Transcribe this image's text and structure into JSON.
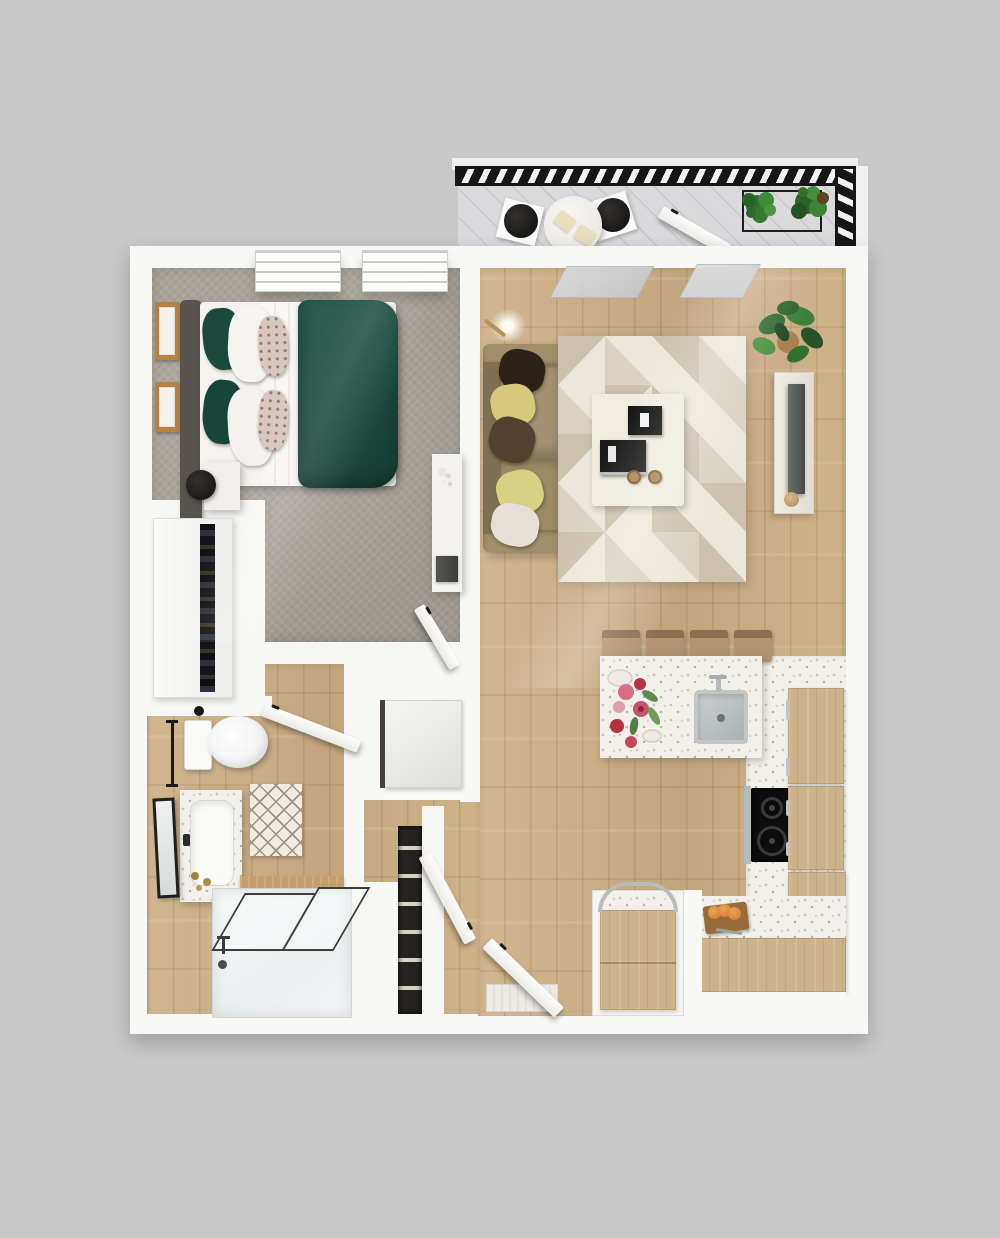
{
  "meta": {
    "scene": "3D rendered top-down floor plan of a one-bedroom apartment with balcony",
    "visible_text": "none",
    "background_color": "#c8c8c8"
  },
  "palette": {
    "background": "#c8c8c8",
    "walls": "#f7f7f4",
    "wood_floor": "#c9ad85",
    "carpet_gray": "#a8a29a",
    "duvet_green": "#1d4a3f",
    "sofa_olive": "#96865f",
    "cabinet_wood": "#cdb38c",
    "terrazzo_counter": "#f2f0ea",
    "railing_black": "#161616",
    "plant_green": "#3a7d36",
    "stainless_steel": "#b7bab9",
    "cooktop_black": "#0d0d0d",
    "accent_brass": "#a6813e"
  },
  "rooms": {
    "balcony": {
      "label": "Balcony",
      "items": [
        "black hatched safety railing",
        "diagonal plank deck",
        "round bistro table with two place settings",
        "two black bistro chairs",
        "planter stand with two green plants",
        "open balcony door"
      ]
    },
    "bedroom": {
      "label": "Bedroom",
      "items": [
        "queen bed with dark green duvet and white sheets",
        "gray upholstered headboard",
        "green, white and floral throw pillows",
        "tan blanket runner",
        "nightstand with black alarm clock",
        "two wood-framed artworks",
        "two windows",
        "white desk with laptop and flowers",
        "gray carpet",
        "open bedroom door"
      ]
    },
    "closet": {
      "label": "Closet",
      "items": [
        "white wardrobe with hanging clothes gap"
      ]
    },
    "bathroom": {
      "label": "Bathroom",
      "items": [
        "toilet",
        "vanity with inset sink and brass fixtures",
        "black-framed leaning mirror",
        "diamond lattice bath rug",
        "bathtub with glass shower screens",
        "black towel bar",
        "wood shelf over tub",
        "open bathroom door"
      ]
    },
    "hallway": {
      "label": "Hallway / Entry",
      "items": [
        "washer-dryer appliance nook",
        "dark linen shelving",
        "open closet door",
        "open entry door",
        "entry door mat"
      ]
    },
    "living_room": {
      "label": "Living Room",
      "items": [
        "olive three-seat sofa with five throw pillows",
        "floor lamp",
        "geometric triangle area rug",
        "white coffee table with black tray and book",
        "two round wood stools",
        "media console with television",
        "potted fiddle-leaf plant",
        "open sliding glass door panels"
      ]
    },
    "kitchen": {
      "label": "Kitchen",
      "items": [
        "terrazzo peninsula with stainless sink and faucet",
        "four wooden bar stools",
        "flowers and plate styling",
        "tall fridge cabinet",
        "black two-burner cooktop with stainless trim",
        "L-shaped wood cabinets with chrome pulls",
        "kitchen cart with chrome arc handle",
        "cutting board with sliced bread"
      ]
    }
  }
}
